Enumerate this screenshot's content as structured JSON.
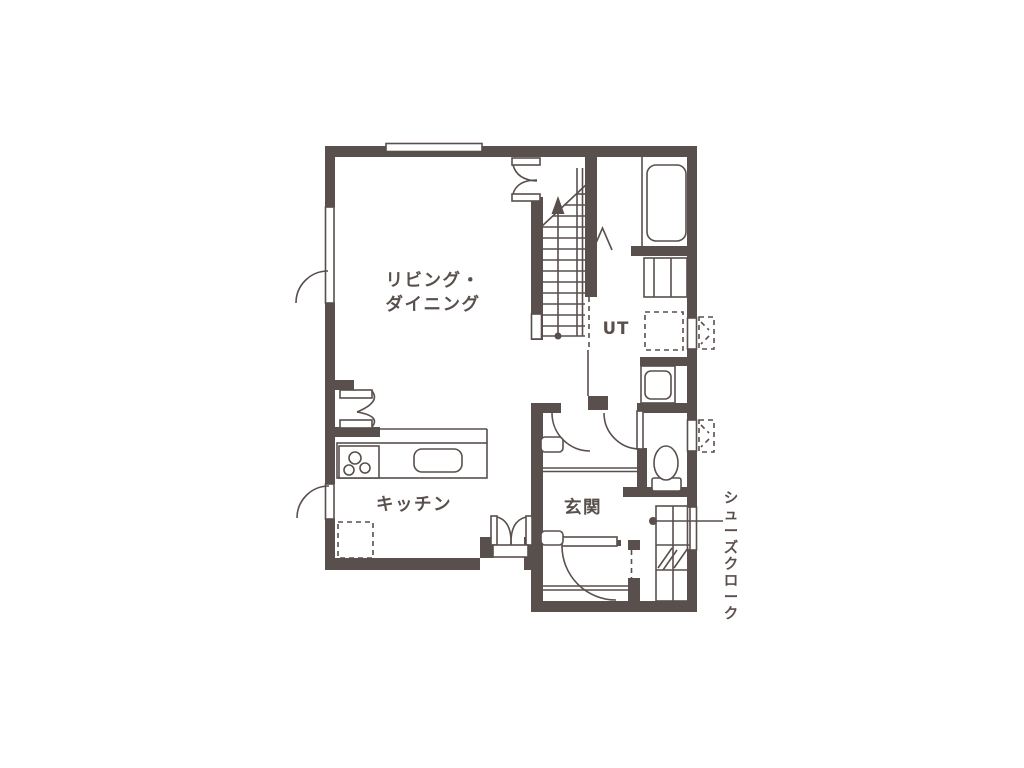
{
  "colors": {
    "wall": "#594f4c",
    "background": "#ffffff"
  },
  "floor_plan": {
    "rooms": {
      "living_dining": {
        "label": [
          "リビング・",
          "ダイニング"
        ]
      },
      "kitchen": {
        "label": "キッチン"
      },
      "entrance": {
        "label": "玄関"
      },
      "utility": {
        "label": "UT"
      },
      "shoe_closet": {
        "label": "シューズクローク"
      }
    }
  }
}
